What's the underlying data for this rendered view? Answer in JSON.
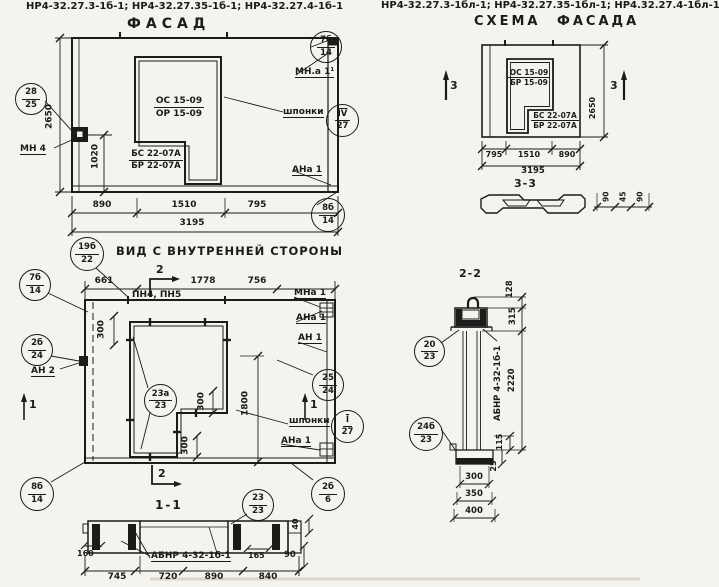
{
  "paper_color": "#f5f3ee",
  "ink_color": "#1b1b1a",
  "titles": {
    "left": "НР4-32.27.3-1б-1; НР4-32.27.35-1б-1; НР4-32.27.4-1б-1",
    "right": "НР4-32.27.3-1бл-1; НР4-32.27.35-1бл-1; НР4.32.27.4-1бл-1"
  },
  "facade": {
    "heading": "ФАСАД",
    "win_top": "ОС 15-09",
    "win_bot": "ОР 15-09",
    "door_top": "БС 22-07А",
    "door_bot": "БР 22-07А",
    "dim_2650": "2650",
    "dim_1020": "1020",
    "dim_890": "890",
    "dim_1510": "1510",
    "dim_795": "795",
    "dim_3195": "3195",
    "mn4": "МН 4",
    "mna1": "МН.а 1¹",
    "shponki": "шпонки",
    "ana1": "АНа 1",
    "c7b_t": "7б",
    "c7b_b": "14",
    "c28_t": "28",
    "c28_b": "25",
    "csh_t": "IV",
    "csh_b": "27",
    "c8b_t": "8б",
    "c8b_b": "14"
  },
  "scheme": {
    "heading": "СХЕМА ФАСАДА",
    "win_top": "ОС 15-09",
    "win_bot": "БР 15-09",
    "door_top": "БС 22-07А",
    "door_bot": "БР 22-07А",
    "dim_2650": "2650",
    "dim_795": "795",
    "dim_1510": "1510",
    "dim_890": "890",
    "dim_3195": "3195",
    "sec3": "3",
    "s33_heading": "3-3",
    "s33_d1": "90",
    "s33_d2": "45",
    "s33_d3": "90"
  },
  "interior": {
    "heading": "ВИД С ВНУТРЕННЕЙ СТОРОНЫ",
    "dim_661": "661",
    "dim_1778": "1778",
    "dim_756": "756",
    "pn": "ПН4, ПН5",
    "dim_300": "300",
    "dim_1800": "1800",
    "mna1": "МНа 1",
    "ana1": "АНа 1",
    "an1": "АН 1",
    "an2": "АН 2",
    "shponki": "шпонки",
    "ana1b": "АНа 1",
    "sec1": "1",
    "sec2": "2",
    "c19_t": "19б",
    "c19_b": "22",
    "c7b_t": "7б",
    "c7b_b": "14",
    "c2b24_t": "2б",
    "c2b24_b": "24",
    "c2524_t": "25",
    "c2524_b": "24",
    "csh_t": "I",
    "csh_b": "27",
    "c23a_t": "23а",
    "c23a_b": "23",
    "c8b_t": "8б",
    "c8b_b": "14",
    "c2b6_t": "2б",
    "c2b6_b": "6"
  },
  "s11": {
    "heading": "1-1",
    "label": "АБНР 4-32-1б-1",
    "c23_t": "23",
    "c23_b": "23",
    "dim_160": "160",
    "dim_165": "165",
    "dim_90": "90",
    "dim_40": "40",
    "dim_745": "745",
    "dim_720": "720",
    "dim_890": "890",
    "dim_840": "840"
  },
  "s22": {
    "heading": "2-2",
    "label": "АБНР 4-32-1б-1",
    "c20_t": "20",
    "c20_b": "23",
    "c24_t": "24б",
    "c24_b": "23",
    "dim_128": "128",
    "dim_315": "315",
    "dim_2220": "2220",
    "dim_115": "115",
    "dim_25": "25",
    "dim_300": "300",
    "dim_350": "350",
    "dim_400": "400"
  }
}
